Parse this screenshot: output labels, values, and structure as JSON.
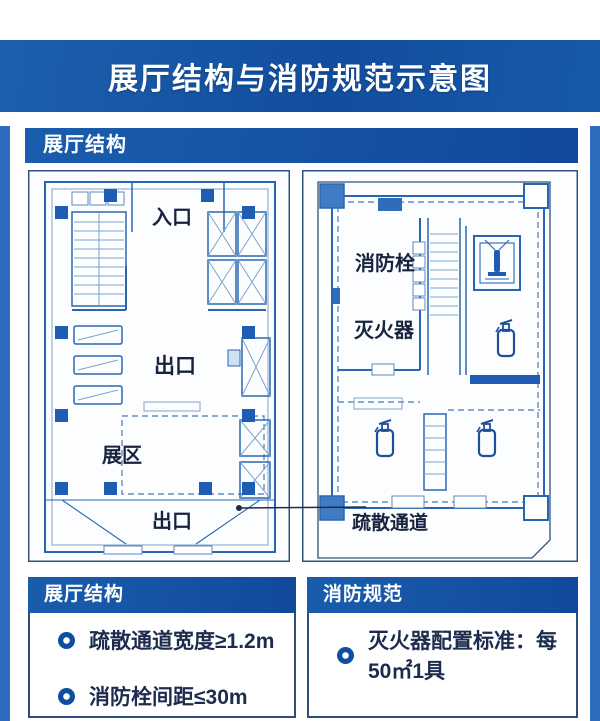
{
  "page": {
    "title": "展厅结构与消防规范示意图"
  },
  "section": {
    "header": "展厅结构"
  },
  "left_plan": {
    "entrance_label": "入口",
    "center_exit_label": "出口",
    "zone_label": "展区",
    "bottom_exit_label": "出口"
  },
  "right_plan": {
    "hydrant_label": "消防栓",
    "extinguisher_label": "灭火器",
    "corridor_label": "疏散通道"
  },
  "info_panels": [
    {
      "header": "展厅结构",
      "bullets": [
        "疏散通道宽度≥1.2m",
        "消防栓间距≤30m"
      ]
    },
    {
      "header": "消防规范",
      "bullets": [
        "灭火器配置标准：每50㎡1具"
      ]
    }
  ],
  "colors": {
    "band_blue": "#124d9e",
    "edge_blue": "#2d6dc0",
    "plan_line_blue": "#2a66b0",
    "solid_fill_blue": "#1f5cb3",
    "text_navy": "#1d2c4e",
    "card_border": "#32517c"
  }
}
